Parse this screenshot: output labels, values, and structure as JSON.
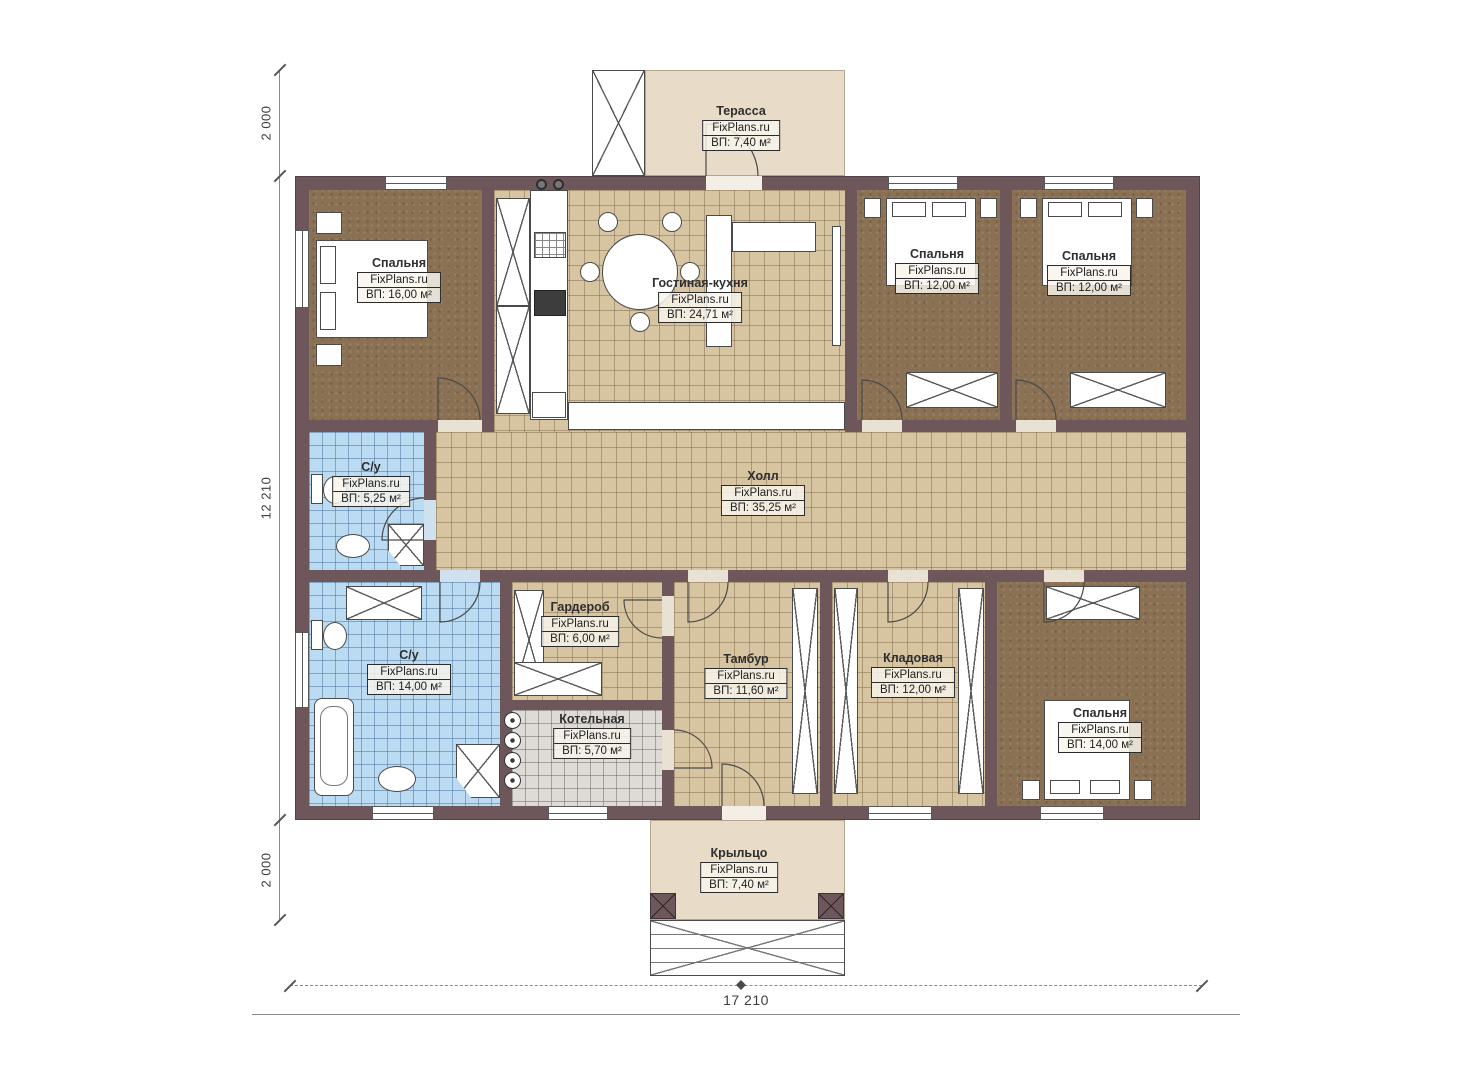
{
  "plan": {
    "dimensions": {
      "left_top": "2 000",
      "left_middle": "12 210",
      "left_bottom": "2 000",
      "bottom": "17 210"
    },
    "rooms": {
      "terrace": {
        "name": "Терасса",
        "brand": "FixPlans.ru",
        "area": "ВП: 7,40 м²"
      },
      "bedroom1": {
        "name": "Спальня",
        "brand": "FixPlans.ru",
        "area": "ВП: 16,00 м²"
      },
      "kitchen": {
        "name": "Гостиная-кухня",
        "brand": "FixPlans.ru",
        "area": "ВП: 24,71 м²"
      },
      "bedroom2": {
        "name": "Спальня",
        "brand": "FixPlans.ru",
        "area": "ВП: 12,00 м²"
      },
      "bedroom3": {
        "name": "Спальня",
        "brand": "FixPlans.ru",
        "area": "ВП: 12,00 м²"
      },
      "hall": {
        "name": "Холл",
        "brand": "FixPlans.ru",
        "area": "ВП: 35,25 м²"
      },
      "bath_top": {
        "name": "С/у",
        "brand": "FixPlans.ru",
        "area": "ВП: 5,25 м²"
      },
      "wardrobe": {
        "name": "Гардероб",
        "brand": "FixPlans.ru",
        "area": "ВП: 6,00 м²"
      },
      "bath_bottom": {
        "name": "С/у",
        "brand": "FixPlans.ru",
        "area": "ВП: 14,00 м²"
      },
      "vestibule": {
        "name": "Тамбур",
        "brand": "FixPlans.ru",
        "area": "ВП: 11,60 м²"
      },
      "storage": {
        "name": "Кладовая",
        "brand": "FixPlans.ru",
        "area": "ВП: 12,00 м²"
      },
      "boiler": {
        "name": "Котельная",
        "brand": "FixPlans.ru",
        "area": "ВП: 5,70 м²"
      },
      "bedroom4": {
        "name": "Спальня",
        "brand": "FixPlans.ru",
        "area": "ВП: 14,00 м²"
      },
      "porch": {
        "name": "Крыльцо",
        "brand": "FixPlans.ru",
        "area": "ВП: 7,40 м²"
      }
    },
    "colors": {
      "wall": "#6d575b",
      "terrace_floor": "#e8dcc8",
      "bedroom_floor": "#8a7153",
      "tile_beige": "#d7c4a1",
      "tile_blue": "#badbf2",
      "tile_gray": "#dedbd6"
    }
  }
}
